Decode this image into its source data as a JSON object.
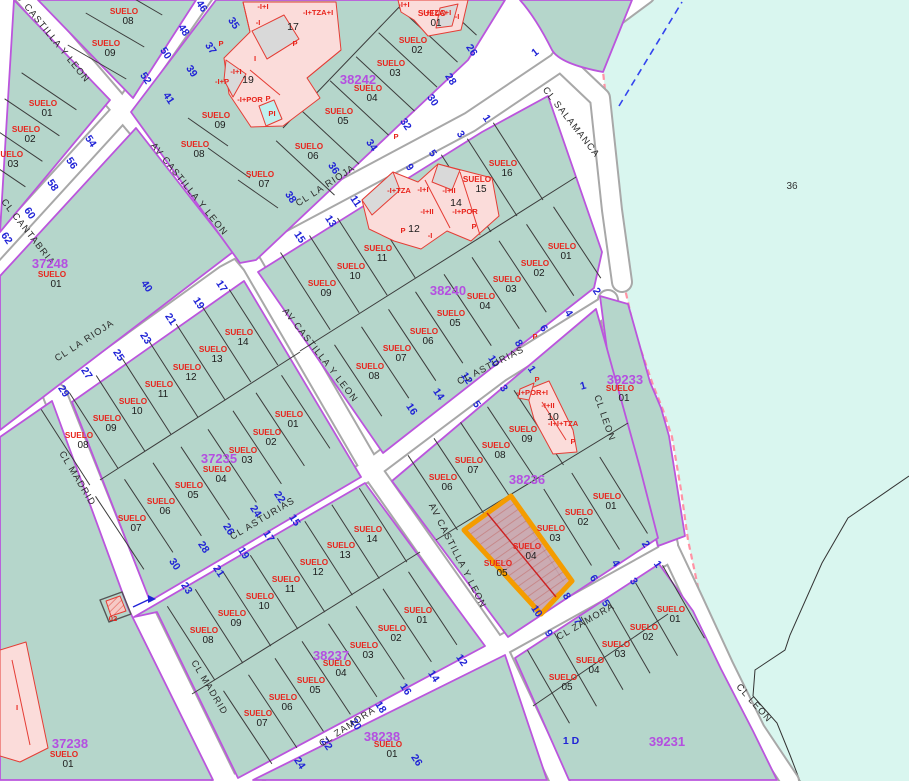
{
  "app": {
    "type": "cadastral-map-viewer"
  },
  "colors": {
    "block_fill": "#b5d6cb",
    "block_border": "#bb55dd",
    "street_fill": "#ffffff",
    "street_casing": "#a8a8a8",
    "parcel_line": "#3c3c3c",
    "suelo_red": "#e8241c",
    "street_number_blue": "#2023d6",
    "block_id_purple": "#b44fe0",
    "building_pink": "#fbdcda",
    "building_red": "#e53d35",
    "building_gray": "#d9d9d9",
    "pool_cyan": "#bff0ee",
    "water_fill": "#d9f6ef",
    "water_boundary_pink": "#ff93a5",
    "highlight_orange": "#f49c00",
    "highlight_fill": "#cda7b0"
  },
  "water": {
    "label": "36",
    "x": 792,
    "y": 189
  },
  "street_names": [
    {
      "t": "AV CASTILLA Y LEON",
      "x": 49,
      "y": 38,
      "r": 51
    },
    {
      "t": "AV CASTILLA Y LEON",
      "x": 187,
      "y": 191,
      "r": 51
    },
    {
      "t": "AV CASTILLA Y LEON",
      "x": 318,
      "y": 357,
      "r": 52
    },
    {
      "t": "AV CASTILLA Y LEON",
      "x": 455,
      "y": 557,
      "r": 63
    },
    {
      "t": "CL LA RIOJA",
      "x": 86,
      "y": 343,
      "r": -33
    },
    {
      "t": "CL LA RIOJA",
      "x": 327,
      "y": 188,
      "r": -33
    },
    {
      "t": "CL SALAMANCA",
      "x": 569,
      "y": 124,
      "r": 52
    },
    {
      "t": "CL CANTABRIA",
      "x": 26,
      "y": 234,
      "r": 52
    },
    {
      "t": "CL MADRID",
      "x": 75,
      "y": 480,
      "r": 59
    },
    {
      "t": "CL MADRID",
      "x": 207,
      "y": 689,
      "r": 59
    },
    {
      "t": "CL ASTURIAS",
      "x": 264,
      "y": 521,
      "r": -31
    },
    {
      "t": "CL ASTURIAS",
      "x": 492,
      "y": 368,
      "r": -27
    },
    {
      "t": "CL ZAMORA",
      "x": 349,
      "y": 729,
      "r": -33
    },
    {
      "t": "CL ZAMORA",
      "x": 587,
      "y": 624,
      "r": -30
    },
    {
      "t": "CL LEON",
      "x": 602,
      "y": 419,
      "r": 71
    },
    {
      "t": "CL LEON",
      "x": 752,
      "y": 705,
      "r": 48
    }
  ],
  "street_numbers": [
    {
      "t": "46",
      "x": 199,
      "y": 8,
      "r": 56
    },
    {
      "t": "48",
      "x": 181,
      "y": 32,
      "r": 56
    },
    {
      "t": "50",
      "x": 163,
      "y": 55,
      "r": 56
    },
    {
      "t": "52",
      "x": 143,
      "y": 80,
      "r": 56
    },
    {
      "t": "54",
      "x": 88,
      "y": 143,
      "r": 56
    },
    {
      "t": "56",
      "x": 69,
      "y": 165,
      "r": 56
    },
    {
      "t": "58",
      "x": 50,
      "y": 187,
      "r": 56
    },
    {
      "t": "60",
      "x": 27,
      "y": 215,
      "r": 56
    },
    {
      "t": "62",
      "x": 4,
      "y": 240,
      "r": 56
    },
    {
      "t": "35",
      "x": 231,
      "y": 25,
      "r": 56
    },
    {
      "t": "37",
      "x": 208,
      "y": 50,
      "r": 56
    },
    {
      "t": "39",
      "x": 189,
      "y": 73,
      "r": 56
    },
    {
      "t": "41",
      "x": 166,
      "y": 100,
      "r": 56
    },
    {
      "t": "26",
      "x": 469,
      "y": 52,
      "r": 56
    },
    {
      "t": "28",
      "x": 448,
      "y": 81,
      "r": 56
    },
    {
      "t": "30",
      "x": 430,
      "y": 102,
      "r": 56
    },
    {
      "t": "32",
      "x": 403,
      "y": 126,
      "r": 56
    },
    {
      "t": "34",
      "x": 369,
      "y": 147,
      "r": 56
    },
    {
      "t": "36",
      "x": 331,
      "y": 170,
      "r": 56
    },
    {
      "t": "38",
      "x": 288,
      "y": 199,
      "r": 56
    },
    {
      "t": "40",
      "x": 144,
      "y": 288,
      "r": 56
    },
    {
      "t": "1",
      "x": 484,
      "y": 120,
      "r": 56
    },
    {
      "t": "3",
      "x": 458,
      "y": 136,
      "r": 56
    },
    {
      "t": "5",
      "x": 430,
      "y": 155,
      "r": 56
    },
    {
      "t": "9",
      "x": 407,
      "y": 169,
      "r": 56
    },
    {
      "t": "11",
      "x": 353,
      "y": 203,
      "r": 56
    },
    {
      "t": "13",
      "x": 328,
      "y": 223,
      "r": 56
    },
    {
      "t": "15",
      "x": 297,
      "y": 239,
      "r": 56
    },
    {
      "t": "17",
      "x": 219,
      "y": 288,
      "r": 56
    },
    {
      "t": "19",
      "x": 196,
      "y": 305,
      "r": 56
    },
    {
      "t": "21",
      "x": 168,
      "y": 321,
      "r": 56
    },
    {
      "t": "23",
      "x": 143,
      "y": 340,
      "r": 56
    },
    {
      "t": "25",
      "x": 116,
      "y": 357,
      "r": 56
    },
    {
      "t": "27",
      "x": 84,
      "y": 375,
      "r": 56
    },
    {
      "t": "29",
      "x": 61,
      "y": 393,
      "r": 56
    },
    {
      "t": "22",
      "x": 277,
      "y": 499,
      "r": 56
    },
    {
      "t": "24",
      "x": 253,
      "y": 513,
      "r": 56
    },
    {
      "t": "26",
      "x": 226,
      "y": 531,
      "r": 56
    },
    {
      "t": "28",
      "x": 201,
      "y": 549,
      "r": 56
    },
    {
      "t": "30",
      "x": 172,
      "y": 566,
      "r": 56
    },
    {
      "t": "15",
      "x": 292,
      "y": 522,
      "r": 56
    },
    {
      "t": "17",
      "x": 266,
      "y": 538,
      "r": 56
    },
    {
      "t": "19",
      "x": 241,
      "y": 555,
      "r": 56
    },
    {
      "t": "21",
      "x": 216,
      "y": 573,
      "r": 56
    },
    {
      "t": "23",
      "x": 184,
      "y": 590,
      "r": 56
    },
    {
      "t": "2",
      "x": 594,
      "y": 293,
      "r": 56
    },
    {
      "t": "4",
      "x": 566,
      "y": 315,
      "r": 56
    },
    {
      "t": "6",
      "x": 541,
      "y": 330,
      "r": 56
    },
    {
      "t": "8",
      "x": 516,
      "y": 345,
      "r": 56
    },
    {
      "t": "10",
      "x": 491,
      "y": 363,
      "r": 56
    },
    {
      "t": "12",
      "x": 464,
      "y": 380,
      "r": 56
    },
    {
      "t": "14",
      "x": 436,
      "y": 396,
      "r": 56
    },
    {
      "t": "16",
      "x": 409,
      "y": 411,
      "r": 56
    },
    {
      "t": "1",
      "x": 529,
      "y": 371,
      "r": 56
    },
    {
      "t": "3",
      "x": 501,
      "y": 390,
      "r": 56
    },
    {
      "t": "5",
      "x": 474,
      "y": 406,
      "r": 56
    },
    {
      "t": "12",
      "x": 459,
      "y": 662,
      "r": 56
    },
    {
      "t": "14",
      "x": 431,
      "y": 678,
      "r": 56
    },
    {
      "t": "16",
      "x": 403,
      "y": 691,
      "r": 56
    },
    {
      "t": "18",
      "x": 378,
      "y": 709,
      "r": 56
    },
    {
      "t": "20",
      "x": 353,
      "y": 726,
      "r": 56
    },
    {
      "t": "22",
      "x": 324,
      "y": 746,
      "r": 56
    },
    {
      "t": "24",
      "x": 297,
      "y": 765,
      "r": 56
    },
    {
      "t": "26",
      "x": 414,
      "y": 762,
      "r": 56
    },
    {
      "t": "2",
      "x": 643,
      "y": 546,
      "r": 56
    },
    {
      "t": "4",
      "x": 613,
      "y": 565,
      "r": 56
    },
    {
      "t": "6",
      "x": 591,
      "y": 580,
      "r": 56
    },
    {
      "t": "8",
      "x": 564,
      "y": 598,
      "r": 56
    },
    {
      "t": "10",
      "x": 534,
      "y": 613,
      "r": 56
    },
    {
      "t": "1",
      "x": 655,
      "y": 566,
      "r": 56
    },
    {
      "t": "3",
      "x": 631,
      "y": 583,
      "r": 56
    },
    {
      "t": "5",
      "x": 603,
      "y": 605,
      "r": 56
    },
    {
      "t": "7",
      "x": 575,
      "y": 623,
      "r": 56
    },
    {
      "t": "9",
      "x": 546,
      "y": 635,
      "r": 56
    },
    {
      "t": "1",
      "x": 537,
      "y": 55,
      "r": -38
    },
    {
      "t": "1",
      "x": 584,
      "y": 389,
      "r": -15
    },
    {
      "t": "1 D",
      "x": 571,
      "y": 744,
      "r": 0
    }
  ],
  "block_ids": [
    {
      "t": "37248",
      "x": 50,
      "y": 268
    },
    {
      "t": "38242",
      "x": 358,
      "y": 84
    },
    {
      "t": "38240",
      "x": 448,
      "y": 295
    },
    {
      "t": "37235",
      "x": 219,
      "y": 463
    },
    {
      "t": "38236",
      "x": 527,
      "y": 484
    },
    {
      "t": "39233",
      "x": 625,
      "y": 384
    },
    {
      "t": "38237",
      "x": 331,
      "y": 660
    },
    {
      "t": "38238",
      "x": 382,
      "y": 741
    },
    {
      "t": "39231",
      "x": 667,
      "y": 746
    },
    {
      "t": "37238",
      "x": 70,
      "y": 748
    }
  ],
  "blocks": [
    {
      "id": "left-strip",
      "parcels": [
        {
          "n": "01",
          "x": 43,
          "y": 106
        },
        {
          "n": "02",
          "x": 26,
          "y": 132
        },
        {
          "n": "03",
          "x": 9,
          "y": 157
        }
      ]
    },
    {
      "id": "wedge",
      "parcels": [
        {
          "n": "08",
          "x": 124,
          "y": 14
        },
        {
          "n": "09",
          "x": 106,
          "y": 46
        }
      ]
    },
    {
      "id": "37248",
      "parcels": [
        {
          "n": "01",
          "x": 52,
          "y": 277
        }
      ]
    },
    {
      "id": "38242",
      "parcels": [
        {
          "n": "01",
          "x": 432,
          "y": 16
        },
        {
          "n": "02",
          "x": 413,
          "y": 43
        },
        {
          "n": "03",
          "x": 391,
          "y": 66
        },
        {
          "n": "04",
          "x": 368,
          "y": 91
        },
        {
          "n": "05",
          "x": 339,
          "y": 114
        },
        {
          "n": "06",
          "x": 309,
          "y": 149
        },
        {
          "n": "07",
          "x": 260,
          "y": 177
        },
        {
          "n": "08",
          "x": 195,
          "y": 147
        },
        {
          "n": "09",
          "x": 216,
          "y": 118
        }
      ]
    },
    {
      "id": "38240",
      "parcels": [
        {
          "n": "09",
          "x": 322,
          "y": 286
        },
        {
          "n": "10",
          "x": 351,
          "y": 269
        },
        {
          "n": "11",
          "x": 378,
          "y": 251
        },
        {
          "n": "15",
          "x": 477,
          "y": 182
        },
        {
          "n": "16",
          "x": 503,
          "y": 166
        },
        {
          "n": "01",
          "x": 562,
          "y": 249
        },
        {
          "n": "02",
          "x": 535,
          "y": 266
        },
        {
          "n": "03",
          "x": 507,
          "y": 282
        },
        {
          "n": "04",
          "x": 481,
          "y": 299
        },
        {
          "n": "05",
          "x": 451,
          "y": 316
        },
        {
          "n": "06",
          "x": 424,
          "y": 334
        },
        {
          "n": "07",
          "x": 397,
          "y": 351
        },
        {
          "n": "08",
          "x": 370,
          "y": 369
        }
      ]
    },
    {
      "id": "39233",
      "parcels": [
        {
          "n": "01",
          "x": 620,
          "y": 391
        }
      ]
    },
    {
      "id": "37235",
      "parcels": [
        {
          "n": "08",
          "x": 79,
          "y": 438
        },
        {
          "n": "09",
          "x": 107,
          "y": 421
        },
        {
          "n": "10",
          "x": 133,
          "y": 404
        },
        {
          "n": "11",
          "x": 159,
          "y": 387
        },
        {
          "n": "12",
          "x": 187,
          "y": 370
        },
        {
          "n": "13",
          "x": 213,
          "y": 352
        },
        {
          "n": "14",
          "x": 239,
          "y": 335
        },
        {
          "n": "07",
          "x": 132,
          "y": 521
        },
        {
          "n": "06",
          "x": 161,
          "y": 504
        },
        {
          "n": "05",
          "x": 189,
          "y": 488
        },
        {
          "n": "04",
          "x": 217,
          "y": 472
        },
        {
          "n": "03",
          "x": 243,
          "y": 453
        },
        {
          "n": "02",
          "x": 267,
          "y": 435
        },
        {
          "n": "01",
          "x": 289,
          "y": 417
        }
      ]
    },
    {
      "id": "38236",
      "parcels": [
        {
          "n": "06",
          "x": 443,
          "y": 480
        },
        {
          "n": "07",
          "x": 469,
          "y": 463
        },
        {
          "n": "08",
          "x": 496,
          "y": 448
        },
        {
          "n": "09",
          "x": 523,
          "y": 432
        },
        {
          "n": "01",
          "x": 607,
          "y": 499
        },
        {
          "n": "02",
          "x": 579,
          "y": 515
        },
        {
          "n": "03",
          "x": 551,
          "y": 531
        },
        {
          "n": "04",
          "x": 527,
          "y": 549
        },
        {
          "n": "05",
          "x": 498,
          "y": 566
        }
      ]
    },
    {
      "id": "38237",
      "parcels": [
        {
          "n": "08",
          "x": 204,
          "y": 633
        },
        {
          "n": "09",
          "x": 232,
          "y": 616
        },
        {
          "n": "10",
          "x": 260,
          "y": 599
        },
        {
          "n": "11",
          "x": 286,
          "y": 582
        },
        {
          "n": "12",
          "x": 314,
          "y": 565
        },
        {
          "n": "13",
          "x": 341,
          "y": 548
        },
        {
          "n": "14",
          "x": 368,
          "y": 532
        },
        {
          "n": "07",
          "x": 258,
          "y": 716
        },
        {
          "n": "06",
          "x": 283,
          "y": 700
        },
        {
          "n": "05",
          "x": 311,
          "y": 683
        },
        {
          "n": "04",
          "x": 337,
          "y": 666
        },
        {
          "n": "03",
          "x": 364,
          "y": 648
        },
        {
          "n": "02",
          "x": 392,
          "y": 631
        },
        {
          "n": "01",
          "x": 418,
          "y": 613
        }
      ]
    },
    {
      "id": "38238",
      "parcels": [
        {
          "n": "01",
          "x": 388,
          "y": 747
        }
      ]
    },
    {
      "id": "39231",
      "parcels": [
        {
          "n": "01",
          "x": 671,
          "y": 612
        },
        {
          "n": "02",
          "x": 644,
          "y": 630
        },
        {
          "n": "03",
          "x": 616,
          "y": 647
        },
        {
          "n": "04",
          "x": 590,
          "y": 663
        },
        {
          "n": "05",
          "x": 563,
          "y": 680
        }
      ]
    },
    {
      "id": "37238",
      "parcels": [
        {
          "n": "01",
          "x": 64,
          "y": 757
        }
      ]
    }
  ],
  "building_labels": [
    {
      "t": "-I+I",
      "x": 263,
      "y": 9,
      "k": "r"
    },
    {
      "t": "-I",
      "x": 258,
      "y": 25,
      "k": "r"
    },
    {
      "t": "17",
      "x": 293,
      "y": 30,
      "k": "b"
    },
    {
      "t": "-I+TZA+I",
      "x": 318,
      "y": 15,
      "k": "r"
    },
    {
      "t": "P",
      "x": 295,
      "y": 46,
      "k": "r"
    },
    {
      "t": "P",
      "x": 221,
      "y": 46,
      "k": "r"
    },
    {
      "t": "I",
      "x": 255,
      "y": 61,
      "k": "r"
    },
    {
      "t": "-I+I",
      "x": 236,
      "y": 74,
      "k": "r"
    },
    {
      "t": "19",
      "x": 248,
      "y": 83,
      "k": "b"
    },
    {
      "t": "-I+P",
      "x": 222,
      "y": 84,
      "k": "r"
    },
    {
      "t": "-I+POR",
      "x": 250,
      "y": 102,
      "k": "r"
    },
    {
      "t": "P",
      "x": 268,
      "y": 101,
      "k": "r"
    },
    {
      "t": "PI",
      "x": 272,
      "y": 116,
      "k": "r"
    },
    {
      "t": "-I+I",
      "x": 404,
      "y": 7,
      "k": "r"
    },
    {
      "t": "-I+TZA+I",
      "x": 436,
      "y": 15,
      "k": "r"
    },
    {
      "t": "-I",
      "x": 457,
      "y": 19,
      "k": "r"
    },
    {
      "t": "P",
      "x": 396,
      "y": 139,
      "k": "r"
    },
    {
      "t": "-I+TZA",
      "x": 399,
      "y": 193,
      "k": "r"
    },
    {
      "t": "-I+I",
      "x": 423,
      "y": 192,
      "k": "r"
    },
    {
      "t": "-I+II",
      "x": 449,
      "y": 193,
      "k": "r"
    },
    {
      "t": "14",
      "x": 456,
      "y": 206,
      "k": "b"
    },
    {
      "t": "-I+POR",
      "x": 465,
      "y": 214,
      "k": "r"
    },
    {
      "t": "-I+II",
      "x": 427,
      "y": 214,
      "k": "r"
    },
    {
      "t": "12",
      "x": 414,
      "y": 232,
      "k": "b"
    },
    {
      "t": "-I",
      "x": 430,
      "y": 238,
      "k": "r"
    },
    {
      "t": "P",
      "x": 403,
      "y": 233,
      "k": "r"
    },
    {
      "t": "P",
      "x": 474,
      "y": 229,
      "k": "r"
    },
    {
      "t": "P",
      "x": 535,
      "y": 339,
      "k": "r"
    },
    {
      "t": "-I+POR+I",
      "x": 532,
      "y": 395,
      "k": "r"
    },
    {
      "t": "-I+II",
      "x": 548,
      "y": 408,
      "k": "r"
    },
    {
      "t": "10",
      "x": 553,
      "y": 420,
      "k": "b"
    },
    {
      "t": "-I+I+TZA",
      "x": 563,
      "y": 426,
      "k": "r"
    },
    {
      "t": "P",
      "x": 573,
      "y": 444,
      "k": "r"
    },
    {
      "t": "P",
      "x": 537,
      "y": 382,
      "k": "r"
    },
    {
      "t": "I",
      "x": 17,
      "y": 710,
      "k": "r"
    },
    {
      "t": "02",
      "x": 113,
      "y": 621,
      "k": "r"
    }
  ],
  "highlight": {
    "block": "38236",
    "parcels": [
      "04",
      "05"
    ]
  }
}
